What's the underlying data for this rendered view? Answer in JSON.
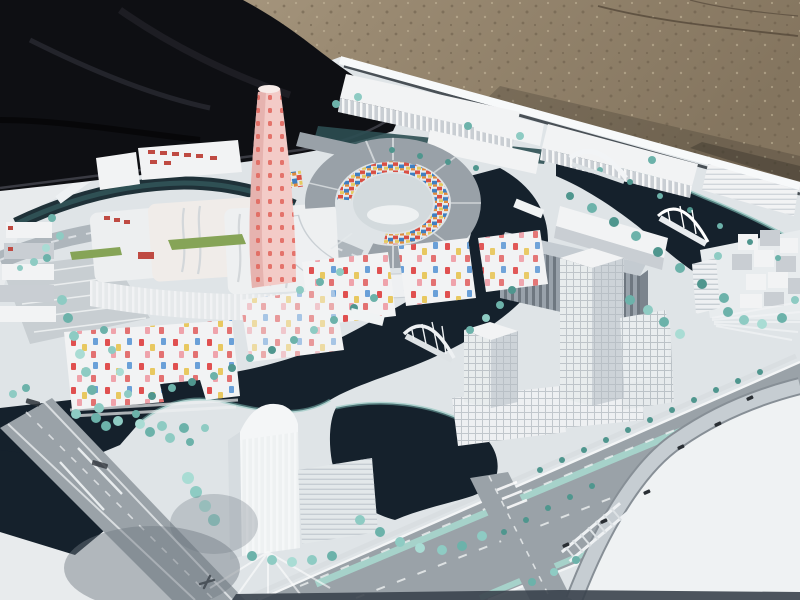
{
  "scene": {
    "alt": "Photograph of a white architectural scale model of a waterfront city district with canals, bridges, towers, a pink dotted landmark tower, a circular court building with colorful mosaic facades, and teal model trees, displayed outdoors on gravel ground with a dark tarp at the upper left corner",
    "setting": "outdoor gravel ground, dark cover tarp, white model baseboard",
    "landmarks": [
      "circular-court-complex-with-mosaic-facade",
      "pink-dotted-landmark-tower",
      "confetti-facade-housing-blocks",
      "twin-white-office-towers",
      "translucent-tower-south",
      "white-cubes-cluster-east",
      "arched-canal-bridges",
      "boulevard-with-tree-medians",
      "tiny-printed-board-marks"
    ]
  },
  "colors": {
    "gravel1": "#9a8a72",
    "gravel2": "#b7a88f",
    "gravel3": "#84755f",
    "speck_dark": "#6b5d4a",
    "speck_light": "#c9bb9f",
    "crack": "#55493a",
    "tarp": "#0e0f13",
    "tarp_fold": "#23242b",
    "tarp_edge": "#3a3b43",
    "board": "#e8ebed",
    "board_edge": "#f7f9fa",
    "gap": "#232b32",
    "district": "#dfe4e7",
    "plaza": "#eff2f3",
    "water": "#15212c",
    "water_teal": "#2c4e52",
    "bank": "#7fc0b8",
    "road": "#9aa2a8",
    "road_light": "#c6cdd2",
    "road_dark": "#878f96",
    "lane": "#f3f5f6",
    "median": "#a6d2ca",
    "building": "#f2f3f4",
    "building_shade": "#c9ced3",
    "building_dark": "#aeb5bb",
    "roof": "#99a1a8",
    "glass": "#99a2ab",
    "glass_dark": "#6e7780",
    "pink": "#f3cbc7",
    "pink_shade": "#e6b3af",
    "pink_dot": "#e2645a",
    "mosaic_red": "#d94f43",
    "mosaic_blue": "#3f7fc1",
    "mosaic_yellow": "#e5c95f",
    "mosaic_orange": "#e08a3c",
    "dot_red": "#e05050",
    "dot_yellow": "#e8c860",
    "dot_blue": "#6aa0d8",
    "dot_pink": "#efa3ab",
    "window_red": "#bf4a42",
    "lawn": "#86a457",
    "tree1": "#8ecbc3",
    "tree2": "#6cb2aa",
    "tree3": "#a9dcd4",
    "tree4": "#4f968e",
    "car": "#2a2f34",
    "mark": "#2f353b",
    "shadow": "#6e7780",
    "strip": "#3a434c"
  }
}
